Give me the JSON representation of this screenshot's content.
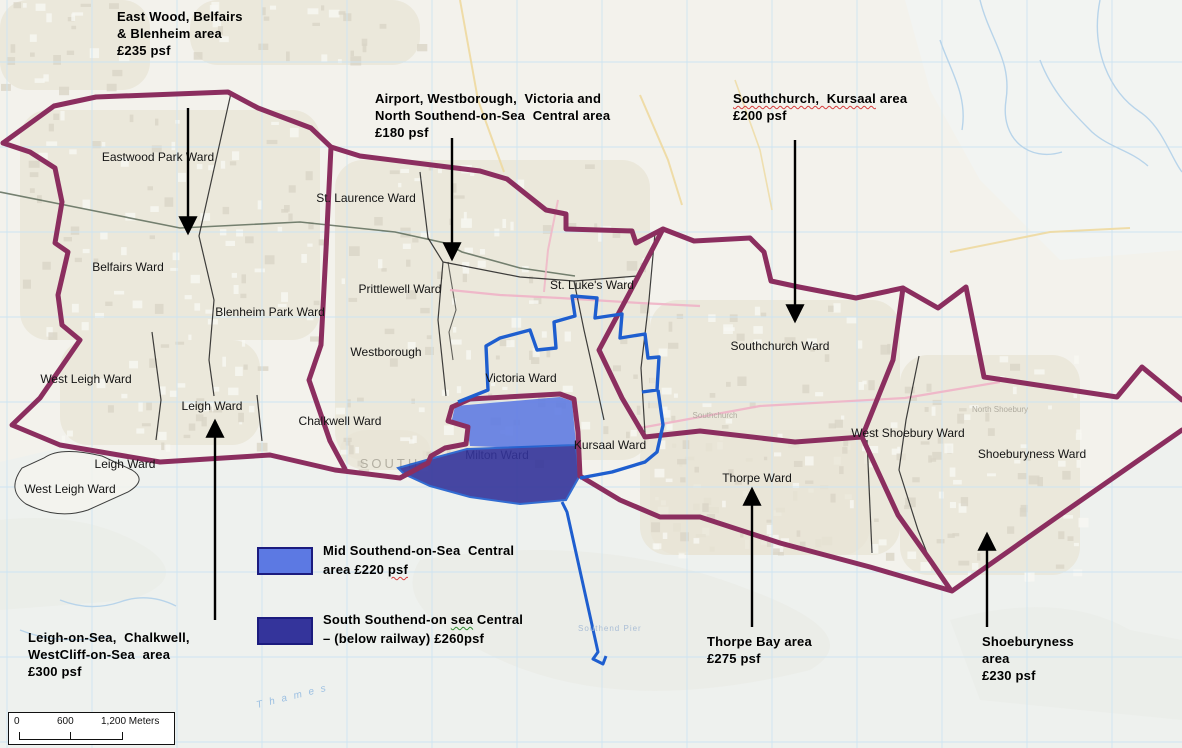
{
  "annotations": {
    "eastwood": {
      "lines": [
        "East Wood, Belfairs",
        "& Blenheim area",
        "£235 psf"
      ]
    },
    "airport": {
      "lines": [
        "Airport, Westborough,  Victoria and",
        "North Southend-on-Sea  Central area",
        "£180 psf"
      ]
    },
    "southchurch": {
      "line1_wavy": "Southchurch,  Kursaal",
      "line1_rest": " area",
      "line2": "£200 psf"
    },
    "leigh": {
      "lines": [
        "Leigh-on-Sea,  Chalkwell,",
        "WestCliff-on-Sea  area",
        "£300 psf"
      ]
    },
    "thorpe": {
      "lines": [
        "Thorpe Bay area",
        "£275 psf"
      ]
    },
    "shoeburyness": {
      "lines": [
        "Shoeburyness",
        "area",
        "£230 psf"
      ]
    }
  },
  "legend": {
    "mid": {
      "line1": "Mid Southend-on-Sea  Central",
      "line2_pre": "area £220 ",
      "line2_wavy": "psf",
      "color": "#5C79E3"
    },
    "south": {
      "line1_pre": "South Southend-on ",
      "line1_wavy": "sea",
      "line1_post": " Central",
      "line2": "– (below railway) £260psf",
      "color": "#34349B"
    }
  },
  "scale_bar": {
    "tick0": "0",
    "tick600": "600",
    "tick1200": "1,200 Meters"
  },
  "wards": [
    {
      "label": "Eastwood Park Ward",
      "x": 158,
      "y": 161
    },
    {
      "label": "Belfairs Ward",
      "x": 128,
      "y": 271
    },
    {
      "label": "Blenheim Park Ward",
      "x": 270,
      "y": 316
    },
    {
      "label": "St. Laurence Ward",
      "x": 366,
      "y": 202
    },
    {
      "label": "Prittlewell Ward",
      "x": 400,
      "y": 293
    },
    {
      "label": "Westborough",
      "x": 386,
      "y": 356
    },
    {
      "label": "Victoria Ward",
      "x": 521,
      "y": 382
    },
    {
      "label": "St. Luke's Ward",
      "x": 592,
      "y": 289
    },
    {
      "label": "West Leigh Ward",
      "x": 86,
      "y": 383
    },
    {
      "label": "Leigh Ward",
      "x": 212,
      "y": 410
    },
    {
      "label": "Leigh Ward",
      "x": 125,
      "y": 468
    },
    {
      "label": "West Leigh Ward",
      "x": 70,
      "y": 493
    },
    {
      "label": "Chalkwell Ward",
      "x": 340,
      "y": 425
    },
    {
      "label": "Milton Ward",
      "x": 497,
      "y": 459,
      "under": true
    },
    {
      "label": "Kursaal Ward",
      "x": 610,
      "y": 449
    },
    {
      "label": "Southchurch Ward",
      "x": 780,
      "y": 350
    },
    {
      "label": "Thorpe Ward",
      "x": 757,
      "y": 482
    },
    {
      "label": "West Shoebury Ward",
      "x": 908,
      "y": 437
    },
    {
      "label": "Shoeburyness Ward",
      "x": 1032,
      "y": 458
    }
  ],
  "map_labels": {
    "pier": "Southend Pier",
    "river": "Thames",
    "city": "SOUTH",
    "place_southchurch": "Southchurch",
    "place_north_shoebury": "North Shoebury"
  },
  "colors": {
    "boundary_purple": "#8B2E5F",
    "mid_blue_fill": "#5C79E3",
    "south_blue_fill": "#34349B",
    "victoria_blue": "#1E5ECF",
    "ward_line": "#1f1f1f",
    "grid_blue": "#cde4f2"
  }
}
